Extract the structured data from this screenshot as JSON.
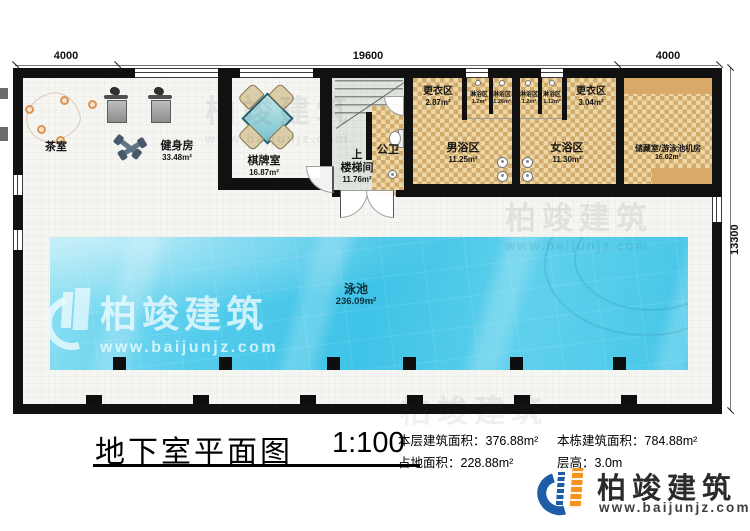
{
  "dimensions": {
    "top_left": "4000",
    "top_center": "19600",
    "top_right": "4000",
    "right_side": "13300"
  },
  "rooms": {
    "tea": {
      "name": "茶室"
    },
    "gym": {
      "name": "健身房",
      "area": "33.48m²"
    },
    "chess": {
      "name": "棋牌室",
      "area": "16.87m²"
    },
    "stairs": {
      "direction": "上",
      "name": "楼梯间",
      "area": "11.76m²"
    },
    "wc": {
      "name": "公卫"
    },
    "men_changing": {
      "name": "更衣区",
      "area": "2.87m²"
    },
    "shower_1": {
      "name": "淋浴区",
      "area": "1.2m²"
    },
    "shower_2": {
      "name": "淋浴区",
      "area": "1.26m²"
    },
    "shower_3": {
      "name": "淋浴区",
      "area": "1.2m²"
    },
    "shower_4": {
      "name": "淋浴区",
      "area": "1.12m²"
    },
    "men_bath": {
      "name": "男浴区",
      "area": "11.25m²"
    },
    "women_bath": {
      "name": "女浴区",
      "area": "11.30m²"
    },
    "women_changing": {
      "name": "更衣区",
      "area": "3.04m²"
    },
    "storage": {
      "name": "储藏室/游泳池机房",
      "area": "16.02m²"
    },
    "pool": {
      "name": "泳池",
      "area": "236.09m²"
    }
  },
  "footer": {
    "title": "地下室平面图",
    "scale": "1:100",
    "stats": [
      {
        "label": "本层建筑面积：",
        "value": "376.88m²"
      },
      {
        "label": "本栋建筑面积：",
        "value": "784.88m²"
      },
      {
        "label": "占地面积：",
        "value": "228.88m²"
      },
      {
        "label": "层高：",
        "value": "3.0m"
      }
    ],
    "brand_name": "柏竣建筑",
    "brand_url": "www.baijunjz.com"
  },
  "watermark": {
    "name": "柏竣建筑",
    "url": "www.baijunjz.com"
  },
  "colors": {
    "wall": "#111111",
    "bath_tile_light": "#ecd7a8",
    "bath_tile_dark": "#d2ab6a",
    "pool_blue": "#45c6e8",
    "stair_floor": "#e0e6df",
    "brand_blue": "#1d5ca6",
    "brand_orange": "#f6921e"
  }
}
